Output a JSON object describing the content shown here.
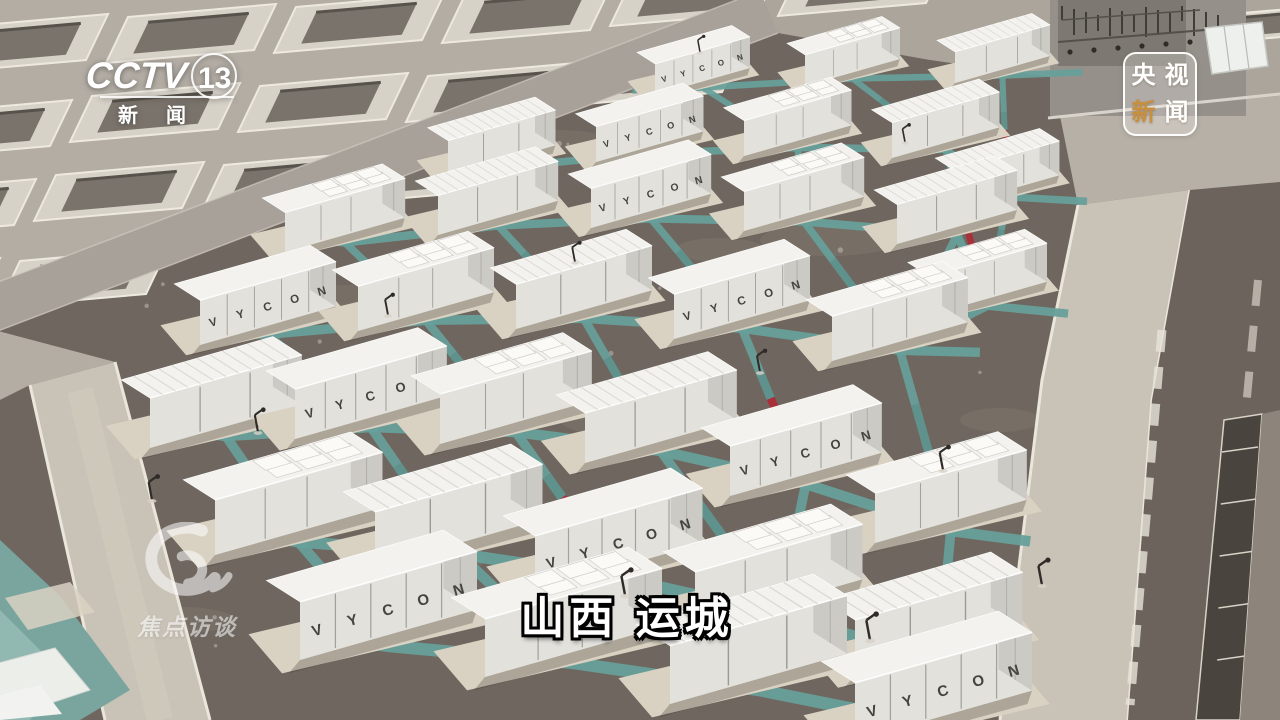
{
  "broadcast_overlays": {
    "channel_logo": {
      "network": "CCTV",
      "channel_number": "13",
      "sub_char1": "新",
      "sub_char2": "闻"
    },
    "news_badge": {
      "chars": [
        "央",
        "视",
        "新",
        "闻"
      ],
      "highlight_color": "#c88f3e"
    },
    "program_watermark": {
      "text": "焦点访谈"
    },
    "location_caption": {
      "text": "山西 运城"
    }
  },
  "scene": {
    "container_brand_text": "VYCON",
    "palette": {
      "gravel": "#6f675f",
      "concrete": "#b3ada4",
      "concrete_right": "#aba59c",
      "road_gray": "#a7a199",
      "road_beige": "#c9c2b6",
      "curb_white": "#ebe6dc",
      "walkway_teal": "#67a09a",
      "walkway_teal_dark": "#558780",
      "marker_red": "#a83038",
      "pad_beige": "#d9d1c2",
      "container_front": "#e2e1dc",
      "container_roof": "#f3f2ee",
      "container_end": "#cbcac4",
      "pit_frame": "#d7d2c8",
      "pit_inner": "#7a736b",
      "teal_corner": "#7aa59f"
    }
  }
}
